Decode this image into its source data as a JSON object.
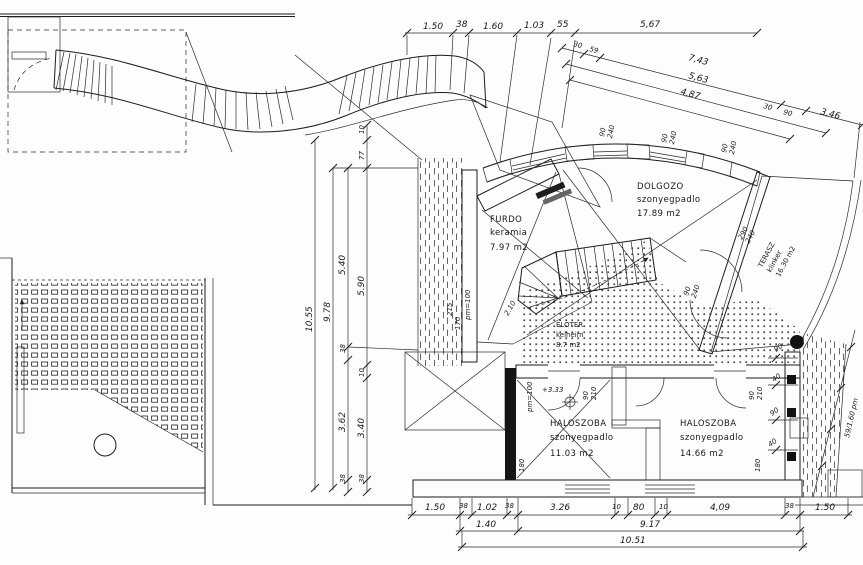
{
  "drawing_type": "architectural floor plan",
  "rooms": {
    "furdo": {
      "name": "FURDO",
      "floor": "keramia",
      "area": "7.97 m2"
    },
    "dolgozo": {
      "name": "DOLGOZO",
      "floor": "szonyegpadlo",
      "area": "17.89 m2"
    },
    "eloter": {
      "name": "ELOTER",
      "floor": "kelheim",
      "area": "8.7 m2"
    },
    "haloszoba1": {
      "name": "HALOSZOBA",
      "floor": "szonyegpadlo",
      "area": "11.03 m2"
    },
    "haloszoba2": {
      "name": "HALOSZOBA",
      "floor": "szonyegpadlo",
      "area": "14.66 m2"
    },
    "terasz": {
      "name": "TERASZ",
      "floor": "klinker",
      "area": "16.30 m2"
    }
  },
  "dims": {
    "top": {
      "a": "1.50",
      "b": "38",
      "c": "1.60",
      "d": "1.03",
      "e": "55",
      "f": "5,67"
    },
    "diag": {
      "s1": "30",
      "s2": "59",
      "l1": "7,43",
      "l2": "5,63",
      "l3": "4,87",
      "e1": "30",
      "e2": "90",
      "e3": "3,46"
    },
    "left": {
      "total": "10.55",
      "b": "9.78",
      "c": "5.40",
      "d": "38",
      "e": "3.62",
      "f": "38",
      "g": "10",
      "h": "77",
      "i": "5.90",
      "j": "10",
      "k": "3.40",
      "l": "38"
    },
    "bottom1": {
      "a": "1.50",
      "b": "38",
      "c": "1.02",
      "d": "38",
      "e": "3.26",
      "f": "10",
      "g": "80",
      "h": "10",
      "i": "4,09",
      "j": "38",
      "k": "1.50"
    },
    "bottom2": {
      "a": "1.40",
      "b": "9.17"
    },
    "bottom3": {
      "a": "10.51"
    },
    "window": {
      "w": "90",
      "h": "240"
    },
    "terrace_door": {
      "w": "290",
      "h": "240"
    },
    "stair_door": {
      "w": "90",
      "h": "240"
    },
    "bedroom_door": {
      "w": "90",
      "h": "210"
    },
    "right": {
      "a": "90",
      "b": "40",
      "c": "90",
      "d": "40",
      "slope": "59/1.60 pm"
    },
    "inner": {
      "pm": "pm=100",
      "level": "+3.33",
      "h180": "180",
      "t215": "215",
      "t170": "170",
      "t210": "2.10"
    }
  }
}
